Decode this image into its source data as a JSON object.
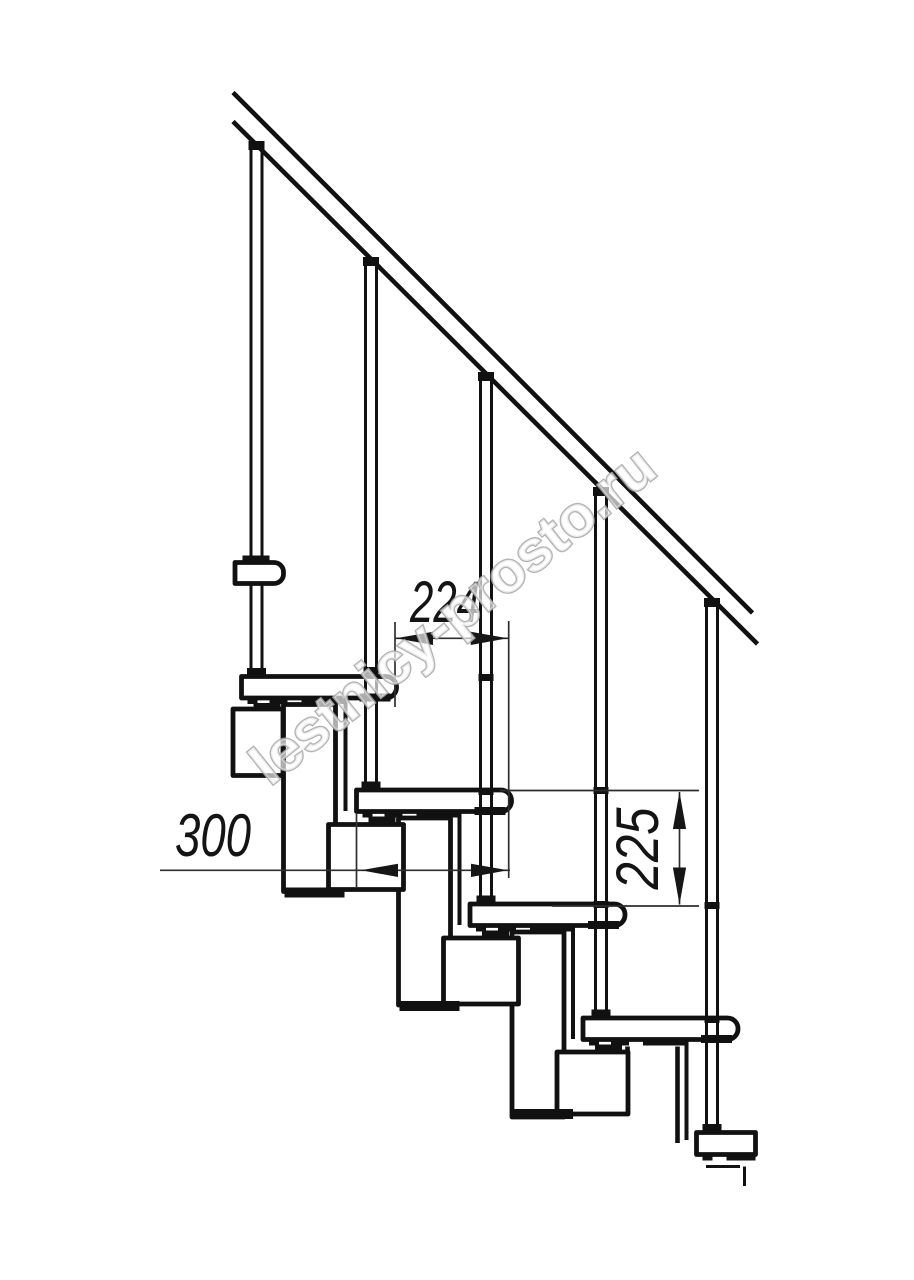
{
  "drawing": {
    "type": "technical-diagram",
    "subject": "modular staircase side elevation",
    "watermark": "lestnicy-prosto.ru",
    "dimensions": {
      "going": {
        "value": "224",
        "orientation": "horizontal"
      },
      "tread_depth": {
        "value": "300",
        "orientation": "horizontal"
      },
      "rise": {
        "value": "225",
        "orientation": "vertical"
      }
    },
    "counts": {
      "treads": 5,
      "balusters": 5,
      "handrail_lines": 2
    },
    "colors": {
      "background": "#ffffff",
      "line": "#111111",
      "dimension_line": "#2e2e2e",
      "watermark_stroke": "#a9a9a9",
      "watermark_fill": "rgba(255,255,255,0.75)"
    }
  }
}
